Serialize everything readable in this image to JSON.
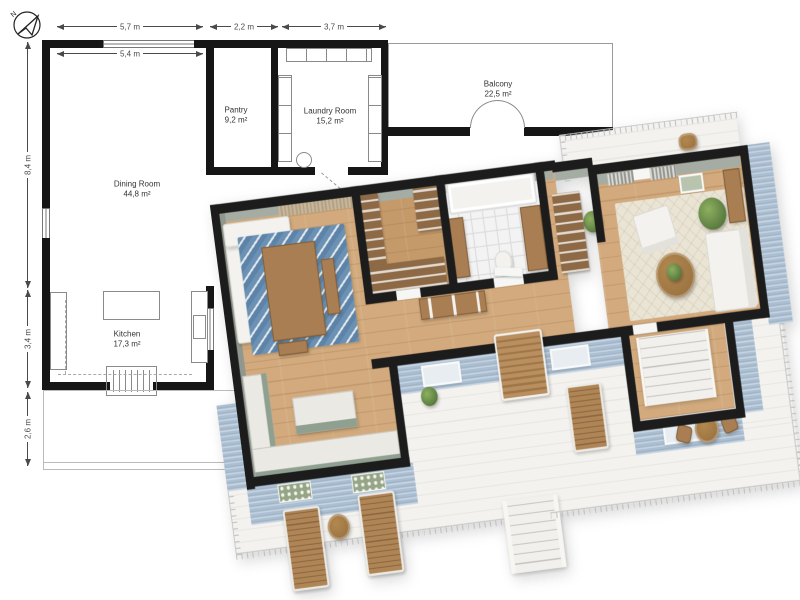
{
  "plan2d": {
    "compass_label": "N",
    "dims": {
      "top": [
        "5,7 m",
        "2,2 m",
        "3,7 m"
      ],
      "inner": "5,4 m",
      "left": [
        "8,4 m",
        "3,4 m",
        "2,6 m"
      ]
    },
    "rooms": [
      {
        "name": "Dining Room",
        "area": "44,8 m²"
      },
      {
        "name": "Kitchen",
        "area": "17,3 m²"
      },
      {
        "name": "Pantry",
        "area": "9,2 m²"
      },
      {
        "name": "Laundry Room",
        "area": "15,2 m²"
      },
      {
        "name": "Balcony",
        "area": "22,5 m²"
      }
    ]
  },
  "colors": {
    "wall_2d": "#161616",
    "wall_3d": "#1c1c1c",
    "dim_line": "#4a4a4a",
    "text": "#333333",
    "thin_line": "#8a8a8a",
    "wood_floor": "#d2aa7d",
    "wood_floor_dark": "#c59a6b",
    "wood_furniture": "#a87e52",
    "wood_shelf": "#8d6a45",
    "tile": "#f3f3f3",
    "deck": "#f3f2ee",
    "siding": "#abbfd3",
    "sage": "#90a090",
    "marble": "#ebe9e4",
    "rug_blue": "#6289ad",
    "rug_beige": "#eae4d5",
    "white_furniture": "#f3f2ee",
    "greenery": "#6d9252",
    "inner_wall": "#a5aca4",
    "inner_wall_dark": "#8f978e",
    "railing": "#c4c4c4",
    "curtain": "#c3b197"
  }
}
